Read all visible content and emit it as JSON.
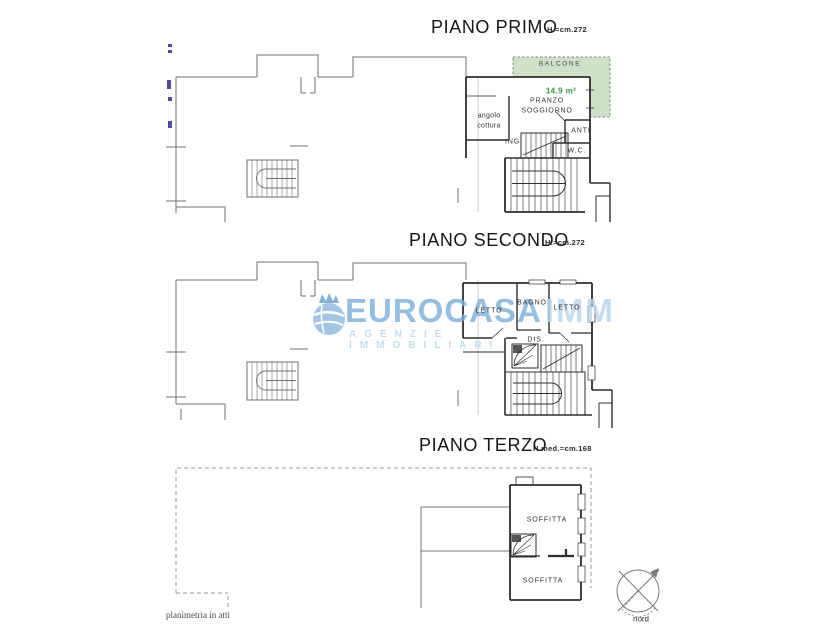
{
  "floors": [
    {
      "title": "PIANO PRIMO",
      "height_label": "H.=cm.272",
      "rooms": {
        "balcone": "BALCONE",
        "balcone_area": "14.9 m²",
        "pranzo_line1": "PRANZO",
        "pranzo_line2": "SOGGIORNO",
        "angolo_line1": "angolo",
        "angolo_line2": "cottura",
        "ing": "ING.",
        "anti": "ANTI",
        "wc": "W.C."
      }
    },
    {
      "title": "PIANO SECONDO",
      "height_label": "H.=cm.272",
      "rooms": {
        "letto_left": "LETTO",
        "bagno": "BAGNO",
        "letto_right": "LETTO",
        "dis": "DIS."
      }
    },
    {
      "title": "PIANO TERZO",
      "height_label": "H.med.=cm.168",
      "rooms": {
        "soffitta_upper": "SOFFITTA",
        "soffitta_lower": "SOFFITTA"
      }
    }
  ],
  "watermark": {
    "brand": "EUROCASA",
    "brand_suffix": "IMM",
    "tagline": "AGENZIE IMMOBILIARI"
  },
  "footer": {
    "note": "planimetria in atti",
    "compass_label": "nord"
  },
  "colors": {
    "balcony_fill": "#cfe0c8",
    "balcony_border": "#7d8f7d",
    "accent_green": "#2f9e44",
    "watermark_blue": "#7fb0da",
    "watermark_light": "#b9d5ec",
    "binding_mark_blue": "#4d4d99"
  }
}
